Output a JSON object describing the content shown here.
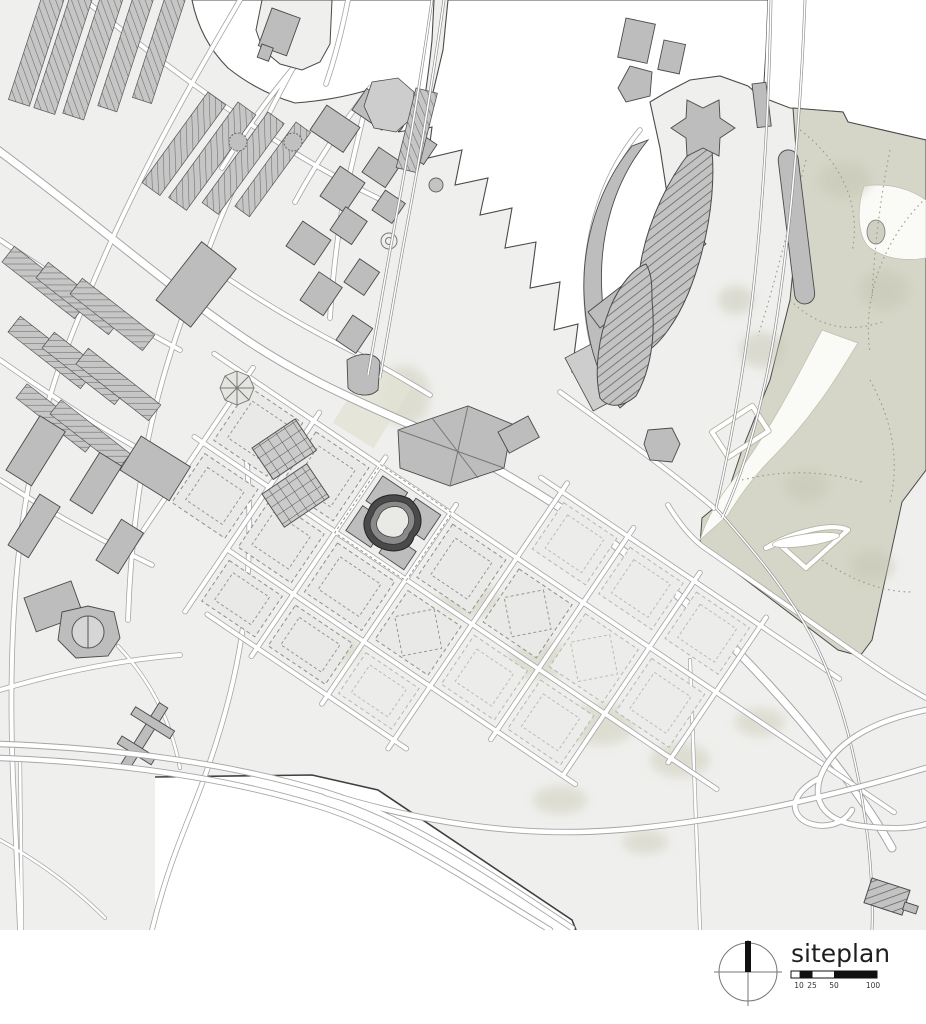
{
  "legend": {
    "title": "siteplan",
    "compass_icon": "north-compass-icon",
    "scale_bar": {
      "ticks": [
        "10",
        "25",
        "50",
        "100"
      ]
    }
  },
  "colors": {
    "paper": "#ffffff",
    "land": "#efefed",
    "water": "#ffffff",
    "park": "#d6d6c8",
    "building": "#bdbdbd",
    "building-light": "#cdcdcd",
    "outline": "#4a4a4a",
    "road-casing": "#a5a5a5",
    "road-fill": "#ffffff",
    "dash-stroke": "#8f8f8f",
    "dash-fill": "#e9e9e7",
    "site-dark": "#3a3a3a",
    "vegetation": "#cfcfbc",
    "trail": "#9a9a85",
    "quay": "#3f3f3f",
    "text": "#1f1f1f"
  }
}
